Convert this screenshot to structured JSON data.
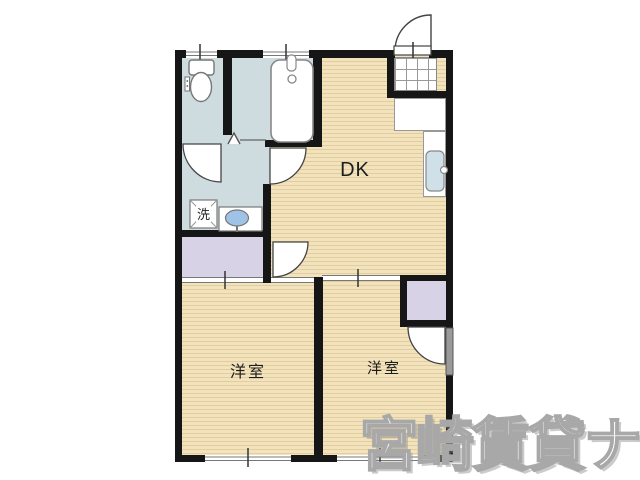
{
  "floor_plan": {
    "rooms": [
      {
        "id": "dining-kitchen",
        "label": "DK"
      },
      {
        "id": "western-room-left",
        "label": "洋室"
      },
      {
        "id": "western-room-right",
        "label": "洋室"
      }
    ],
    "fixtures": {
      "laundry_label": "洗",
      "icons": [
        "toilet-icon",
        "bathtub-icon",
        "washing-machine-icon",
        "wash-basin-icon",
        "kitchen-sink-icon",
        "entry-door-icon",
        "folding-door-icon"
      ]
    },
    "colors": {
      "wall": "#161616",
      "wood_floor": "#f2e3bd",
      "wet_area_floor": "#cedbdf",
      "closet_floor": "#d7d2e6",
      "basin_water": "#9fc3e6",
      "kitchen_sink": "#cfe0e8",
      "door_panel": "#9a9a9a"
    }
  },
  "watermark": {
    "text": "宮崎賃貸ナビ"
  }
}
